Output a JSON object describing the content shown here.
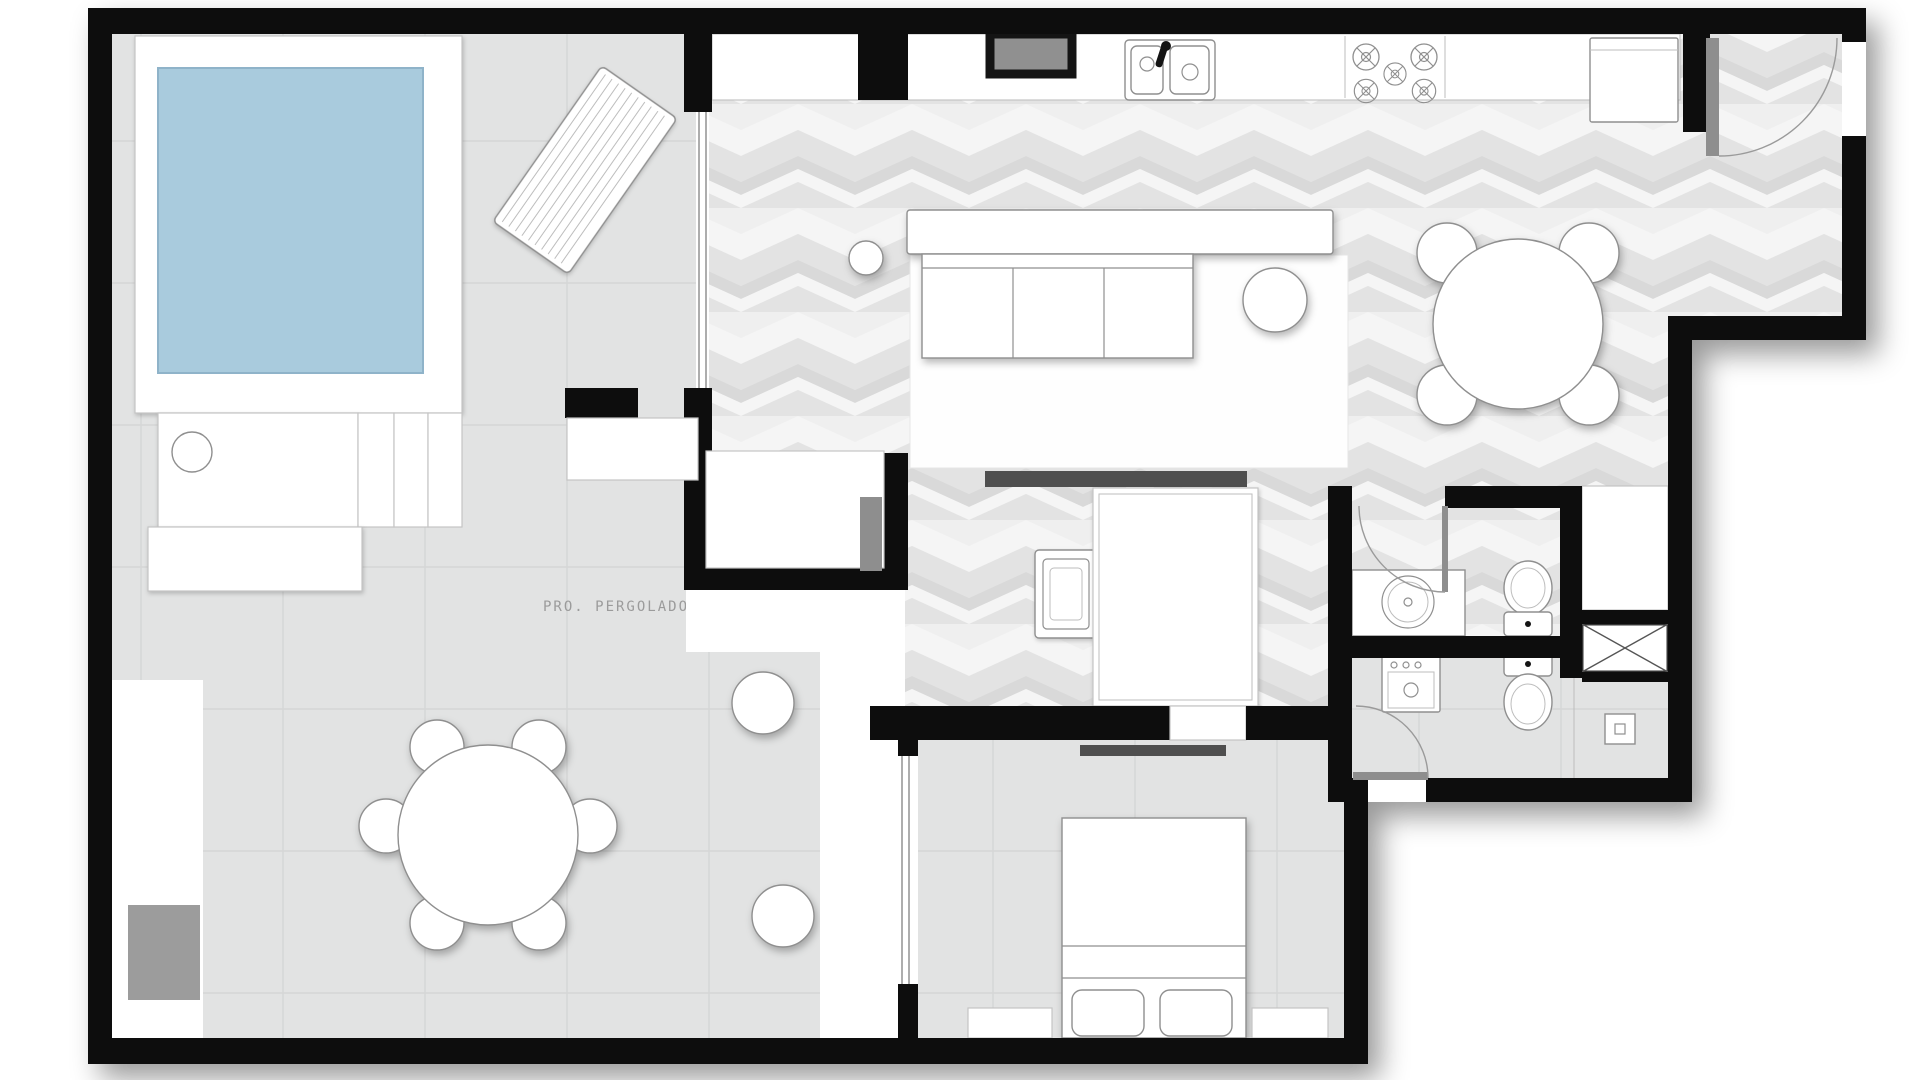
{
  "labels": {
    "pergolado": "PRO. PERGOLADO"
  },
  "colors": {
    "paper": "#ffffff",
    "wall": "#0d0d0d",
    "pool": "#a9cbdd",
    "pool_edge": "#8fb3c9",
    "tile_base": "#e2e3e3",
    "tile_line": "#d5d6d6",
    "herr_a": "#f5f5f5",
    "herr_b": "#e3e3e3",
    "herr_c": "#efefef",
    "herr_d": "#d9d9d9",
    "furniture_line": "#8f8f8f",
    "door_leaf": "#8e8e8e",
    "console_dark": "#4f4f4f",
    "mat_gray": "#9c9c9c",
    "label_text": "#9b9b9b"
  },
  "plan": {
    "type": "apartment-floor-plan",
    "features": [
      "swimming-pool",
      "pool-deck",
      "sun-lounger",
      "pool-bench",
      "deck-steps",
      "pergola-patio",
      "outdoor-round-table-6-chairs",
      "two-poufs",
      "floor-mat",
      "living-room-rug",
      "sofa-3-seat",
      "round-side-table",
      "small-side-table",
      "tv-console",
      "kitchen-counter",
      "double-sink",
      "faucet",
      "stove-5-burners",
      "fridge",
      "wall-niche",
      "entry-door-swing",
      "dining-round-table-4-chairs",
      "hall-armchair",
      "wardrobe",
      "closet-room",
      "bathroom-sink-counter",
      "toilet",
      "bidet",
      "washer",
      "shaft-x-box",
      "floor-drain",
      "service-door-swing",
      "bathroom-door-swing",
      "sliding-glass-doors",
      "bed-double",
      "pillows",
      "nightstands",
      "bedroom-tv-bar",
      "wall-shelf-niche"
    ]
  }
}
